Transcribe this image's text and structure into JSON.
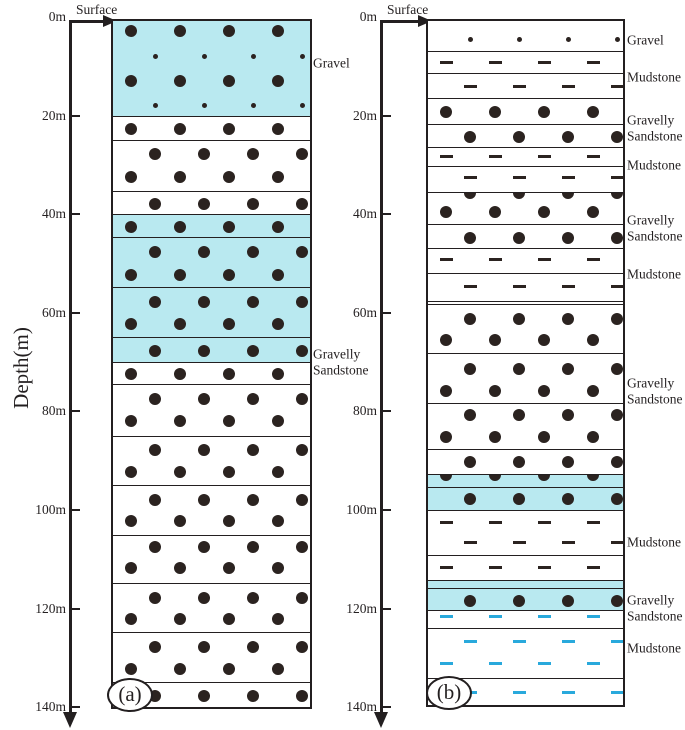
{
  "figure": {
    "depth_axis": {
      "title": "Depth(m)",
      "surface_label": "Surface",
      "tick_labels": [
        "0m",
        "20m",
        "40m",
        "60m",
        "80m",
        "100m",
        "120m",
        "140m"
      ],
      "tick_depths_m": [
        0,
        20,
        40,
        60,
        80,
        100,
        120,
        140
      ],
      "max_depth_m": 140
    },
    "colors": {
      "highlight_fill": "#b9e9f0",
      "pattern_dark": "#2b2320",
      "pattern_blue": "#29a9dc",
      "line": "#231f20",
      "background": "#ffffff"
    },
    "columns": [
      {
        "id": "a",
        "caption": "(a)",
        "side_labels": [
          {
            "text": "Gravel",
            "y": 63
          },
          {
            "text": "Gravelly\nSandstone",
            "y": 362
          }
        ],
        "layers": [
          {
            "t": 0,
            "b": 20,
            "fill": "cyan",
            "lith": "Gravel",
            "rows": [
              {
                "k": "dot-lg",
                "o": "b",
                "f": 0.11
              },
              {
                "k": "dot-sm",
                "o": "a",
                "f": 0.37
              },
              {
                "k": "dot-lg",
                "o": "b",
                "f": 0.63
              },
              {
                "k": "dot-sm",
                "o": "a",
                "f": 0.89
              }
            ]
          },
          {
            "t": 20,
            "b": 25,
            "fill": "white",
            "lith": "Gravelly Sandstone",
            "rows": [
              {
                "k": "dot-lg",
                "o": "b",
                "f": 0.5
              }
            ]
          },
          {
            "t": 25,
            "b": 35.3,
            "fill": "white",
            "lith": "Gravelly Sandstone",
            "rows": [
              {
                "k": "dot-lg",
                "o": "a",
                "f": 0.25
              },
              {
                "k": "dot-lg",
                "o": "b",
                "f": 0.7
              }
            ]
          },
          {
            "t": 35.3,
            "b": 40,
            "fill": "white",
            "lith": "Gravelly Sandstone",
            "rows": [
              {
                "k": "dot-lg",
                "o": "a",
                "f": 0.5
              }
            ]
          },
          {
            "t": 40,
            "b": 44.6,
            "fill": "cyan",
            "lith": "Gravelly Sandstone",
            "rows": [
              {
                "k": "dot-lg",
                "o": "b",
                "f": 0.5
              }
            ]
          },
          {
            "t": 44.6,
            "b": 54.8,
            "fill": "cyan",
            "lith": "Gravelly Sandstone",
            "rows": [
              {
                "k": "dot-lg",
                "o": "a",
                "f": 0.28
              },
              {
                "k": "dot-lg",
                "o": "b",
                "f": 0.73
              }
            ]
          },
          {
            "t": 54.8,
            "b": 64.9,
            "fill": "cyan",
            "lith": "Gravelly Sandstone",
            "rows": [
              {
                "k": "dot-lg",
                "o": "a",
                "f": 0.28
              },
              {
                "k": "dot-lg",
                "o": "b",
                "f": 0.72
              }
            ]
          },
          {
            "t": 64.9,
            "b": 70,
            "fill": "cyan",
            "lith": "Gravelly Sandstone",
            "rows": [
              {
                "k": "dot-lg",
                "o": "a",
                "f": 0.5
              }
            ]
          },
          {
            "t": 70,
            "b": 74.5,
            "fill": "white",
            "lith": "Gravelly Sandstone",
            "rows": [
              {
                "k": "dot-lg",
                "o": "b",
                "f": 0.5
              }
            ]
          },
          {
            "t": 74.5,
            "b": 85,
            "fill": "white",
            "lith": "Gravelly Sandstone",
            "rows": [
              {
                "k": "dot-lg",
                "o": "a",
                "f": 0.27
              },
              {
                "k": "dot-lg",
                "o": "b",
                "f": 0.69
              }
            ]
          },
          {
            "t": 85,
            "b": 95,
            "fill": "white",
            "lith": "Gravelly Sandstone",
            "rows": [
              {
                "k": "dot-lg",
                "o": "a",
                "f": 0.27
              },
              {
                "k": "dot-lg",
                "o": "b",
                "f": 0.7
              }
            ]
          },
          {
            "t": 95,
            "b": 105,
            "fill": "white",
            "lith": "Gravelly Sandstone",
            "rows": [
              {
                "k": "dot-lg",
                "o": "a",
                "f": 0.27
              },
              {
                "k": "dot-lg",
                "o": "b",
                "f": 0.7
              }
            ]
          },
          {
            "t": 105,
            "b": 114.8,
            "fill": "white",
            "lith": "Gravelly Sandstone",
            "rows": [
              {
                "k": "dot-lg",
                "o": "a",
                "f": 0.24
              },
              {
                "k": "dot-lg",
                "o": "b",
                "f": 0.68
              }
            ]
          },
          {
            "t": 114.8,
            "b": 124.8,
            "fill": "white",
            "lith": "Gravelly Sandstone",
            "rows": [
              {
                "k": "dot-lg",
                "o": "a",
                "f": 0.28
              },
              {
                "k": "dot-lg",
                "o": "b",
                "f": 0.72
              }
            ]
          },
          {
            "t": 124.8,
            "b": 134.9,
            "fill": "white",
            "lith": "Gravelly Sandstone",
            "rows": [
              {
                "k": "dot-lg",
                "o": "a",
                "f": 0.28
              },
              {
                "k": "dot-lg",
                "o": "b",
                "f": 0.72
              }
            ]
          },
          {
            "t": 134.9,
            "b": 140,
            "fill": "white",
            "lith": "Gravelly Sandstone",
            "rows": [
              {
                "k": "dot-lg",
                "o": "a",
                "f": 0.5
              }
            ]
          }
        ]
      },
      {
        "id": "b",
        "caption": "(b)",
        "side_labels": [
          {
            "text": "Gravel",
            "y": 40
          },
          {
            "text": "Mudstone",
            "y": 77
          },
          {
            "text": "Gravelly\nSandstone",
            "y": 128
          },
          {
            "text": "Mudstone",
            "y": 165
          },
          {
            "text": "Gravelly\nSandstone",
            "y": 228
          },
          {
            "text": "Mudstone",
            "y": 274
          },
          {
            "text": "Gravelly\nSandstone",
            "y": 391
          },
          {
            "text": "Mudstone",
            "y": 542
          },
          {
            "text": "Gravelly\nSandstone",
            "y": 608
          },
          {
            "text": "Mudstone",
            "y": 648
          }
        ],
        "layers": [
          {
            "t": 0,
            "b": 6.9,
            "fill": "white",
            "lith": "Gravel",
            "rows": [
              {
                "k": "dot-sm",
                "o": "a",
                "f": 0.6
              }
            ]
          },
          {
            "t": 6.9,
            "b": 11.3,
            "fill": "white",
            "lith": "Mudstone",
            "rows": [
              {
                "k": "dash",
                "o": "b",
                "f": 0.5
              }
            ]
          },
          {
            "t": 11.3,
            "b": 16.4,
            "fill": "white",
            "lith": "Mudstone",
            "rows": [
              {
                "k": "dash",
                "o": "a",
                "f": 0.5
              }
            ]
          },
          {
            "t": 16.4,
            "b": 21.7,
            "fill": "white",
            "lith": "Gravelly Sandstone",
            "rows": [
              {
                "k": "dot-lg",
                "o": "b",
                "f": 0.5
              }
            ]
          },
          {
            "t": 21.7,
            "b": 26.4,
            "fill": "white",
            "lith": "Gravelly Sandstone",
            "rows": [
              {
                "k": "dot-lg",
                "o": "a",
                "f": 0.5
              }
            ]
          },
          {
            "t": 26.4,
            "b": 30.2,
            "fill": "white",
            "lith": "Mudstone",
            "rows": [
              {
                "k": "dash",
                "o": "b",
                "f": 0.45
              }
            ]
          },
          {
            "t": 30.2,
            "b": 35.5,
            "fill": "white",
            "lith": "Mudstone",
            "rows": [
              {
                "k": "dash",
                "o": "a",
                "f": 0.42
              }
            ]
          },
          {
            "t": 35.5,
            "b": 42,
            "fill": "white",
            "lith": "Gravelly Sandstone",
            "rows": [
              {
                "k": "dot-lg",
                "o": "a",
                "f": 0
              },
              {
                "k": "dot-lg",
                "o": "b",
                "f": 0.58
              }
            ]
          },
          {
            "t": 42,
            "b": 46.9,
            "fill": "white",
            "lith": "Gravelly Sandstone",
            "rows": [
              {
                "k": "dot-lg",
                "o": "a",
                "f": 0.52
              }
            ]
          },
          {
            "t": 46.9,
            "b": 52,
            "fill": "white",
            "lith": "Mudstone",
            "rows": [
              {
                "k": "dash",
                "o": "b",
                "f": 0.42
              }
            ]
          },
          {
            "t": 52,
            "b": 57.6,
            "fill": "white",
            "lith": "Mudstone",
            "rows": [
              {
                "k": "dash",
                "o": "a",
                "f": 0.45
              }
            ]
          },
          {
            "t": 57.6,
            "b": 58.2,
            "fill": "white",
            "lith": "Mudstone",
            "rows": []
          },
          {
            "t": 58.2,
            "b": 68.2,
            "fill": "white",
            "lith": "Gravelly Sandstone",
            "rows": [
              {
                "k": "dot-lg",
                "o": "a",
                "f": 0.28
              },
              {
                "k": "dot-lg",
                "o": "b",
                "f": 0.72
              }
            ]
          },
          {
            "t": 68.2,
            "b": 78.3,
            "fill": "white",
            "lith": "Gravelly Sandstone",
            "rows": [
              {
                "k": "dot-lg",
                "o": "a",
                "f": 0.3
              },
              {
                "k": "dot-lg",
                "o": "b",
                "f": 0.74
              }
            ]
          },
          {
            "t": 78.3,
            "b": 87.6,
            "fill": "white",
            "lith": "Gravelly Sandstone",
            "rows": [
              {
                "k": "dot-lg",
                "o": "a",
                "f": 0.25
              },
              {
                "k": "dot-lg",
                "o": "b",
                "f": 0.72
              }
            ]
          },
          {
            "t": 87.6,
            "b": 92.7,
            "fill": "white",
            "lith": "Gravelly Sandstone",
            "rows": [
              {
                "k": "dot-lg",
                "o": "a",
                "f": 0.5
              }
            ]
          },
          {
            "t": 92.7,
            "b": 95.3,
            "fill": "cyan",
            "lith": "Gravelly Sandstone",
            "rows": [
              {
                "k": "dot-lg",
                "o": "b",
                "f": 0
              }
            ]
          },
          {
            "t": 95.3,
            "b": 100,
            "fill": "cyan",
            "lith": "Gravelly Sandstone",
            "rows": [
              {
                "k": "dot-lg",
                "o": "a",
                "f": 0.5
              }
            ]
          },
          {
            "t": 100,
            "b": 109.1,
            "fill": "white",
            "lith": "Mudstone",
            "rows": [
              {
                "k": "dash",
                "o": "b",
                "f": 0.25
              },
              {
                "k": "dash",
                "o": "a",
                "f": 0.7
              }
            ]
          },
          {
            "t": 109.1,
            "b": 114.2,
            "fill": "white",
            "lith": "Mudstone",
            "rows": [
              {
                "k": "dash",
                "o": "b",
                "f": 0.45
              }
            ]
          },
          {
            "t": 114.2,
            "b": 115.8,
            "fill": "cyan",
            "lith": "Gravelly Sandstone",
            "rows": []
          },
          {
            "t": 115.8,
            "b": 120.3,
            "fill": "cyan",
            "lith": "Gravelly Sandstone",
            "rows": [
              {
                "k": "dot-lg",
                "o": "a",
                "f": 0.55
              }
            ]
          },
          {
            "t": 120.3,
            "b": 124,
            "fill": "white",
            "lith": "Mudstone",
            "rows": [
              {
                "k": "dash",
                "o": "b",
                "f": 0.3,
                "c": "blue"
              }
            ]
          },
          {
            "t": 124,
            "b": 134.1,
            "fill": "white",
            "lith": "Mudstone",
            "rows": [
              {
                "k": "dash",
                "o": "a",
                "f": 0.25,
                "c": "blue"
              },
              {
                "k": "dash",
                "o": "b",
                "f": 0.68,
                "c": "blue"
              }
            ]
          },
          {
            "t": 134.1,
            "b": 139.6,
            "fill": "white",
            "lith": "Mudstone",
            "rows": [
              {
                "k": "dash",
                "o": "a",
                "f": 0.5,
                "c": "blue"
              }
            ]
          }
        ]
      }
    ]
  }
}
